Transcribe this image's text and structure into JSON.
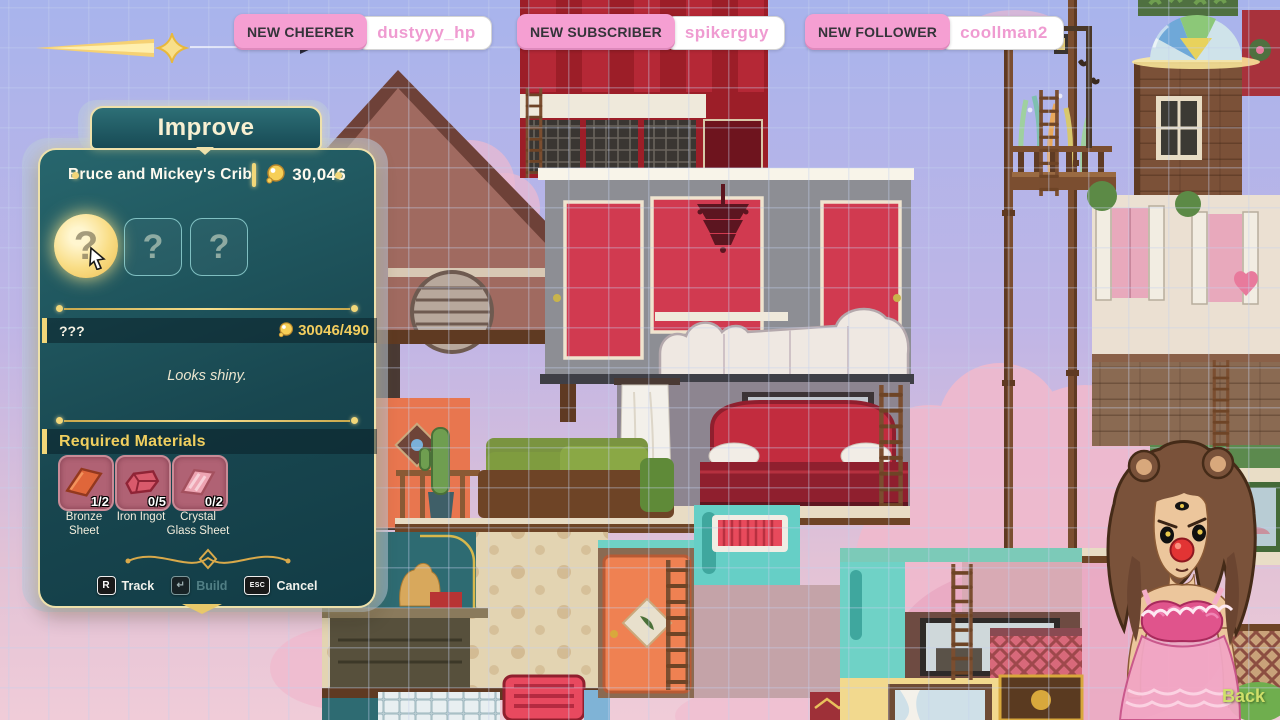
{
  "notifications": [
    {
      "label": "NEW CHEERER",
      "username": "dustyyy_hp"
    },
    {
      "label": "NEW SUBSCRIBER",
      "username": "spikerguy"
    },
    {
      "label": "NEW FOLLOWER",
      "username": "coollman2"
    }
  ],
  "improve_panel": {
    "tab_title": "Improve",
    "header": {
      "building_name": "Bruce and Mickey's Crib",
      "currency_amount": "30,046"
    },
    "upgrade_slots": [
      {
        "glyph": "?",
        "state": "selected"
      },
      {
        "glyph": "?",
        "state": "locked"
      },
      {
        "glyph": "?",
        "state": "locked"
      }
    ],
    "selected_upgrade": {
      "name": "???",
      "progress": "30046/490",
      "description": "Looks shiny."
    },
    "materials_section": {
      "header": "Required Materials",
      "materials": [
        {
          "name": "Bronze Sheet",
          "count": "1/2"
        },
        {
          "name": "Iron Ingot",
          "count": "0/5"
        },
        {
          "name": "Crystal Glass Sheet",
          "count": "0/2"
        }
      ]
    },
    "actions": [
      {
        "key": "R",
        "label": "Track",
        "enabled": true
      },
      {
        "key": "↵",
        "label": "Build",
        "enabled": false
      },
      {
        "key": "ESC",
        "label": "Cancel",
        "enabled": true
      }
    ]
  },
  "hud": {
    "back_label": "Back"
  },
  "colors": {
    "panel_teal": "#1d5a63",
    "gold_accent": "#f2d779",
    "badge_pink": "#f59fd2",
    "username_pink": "#ef9bd1",
    "material_card": "#b06274",
    "back_green": "#cfe06a",
    "currency_gold": "#f2cd5e"
  }
}
